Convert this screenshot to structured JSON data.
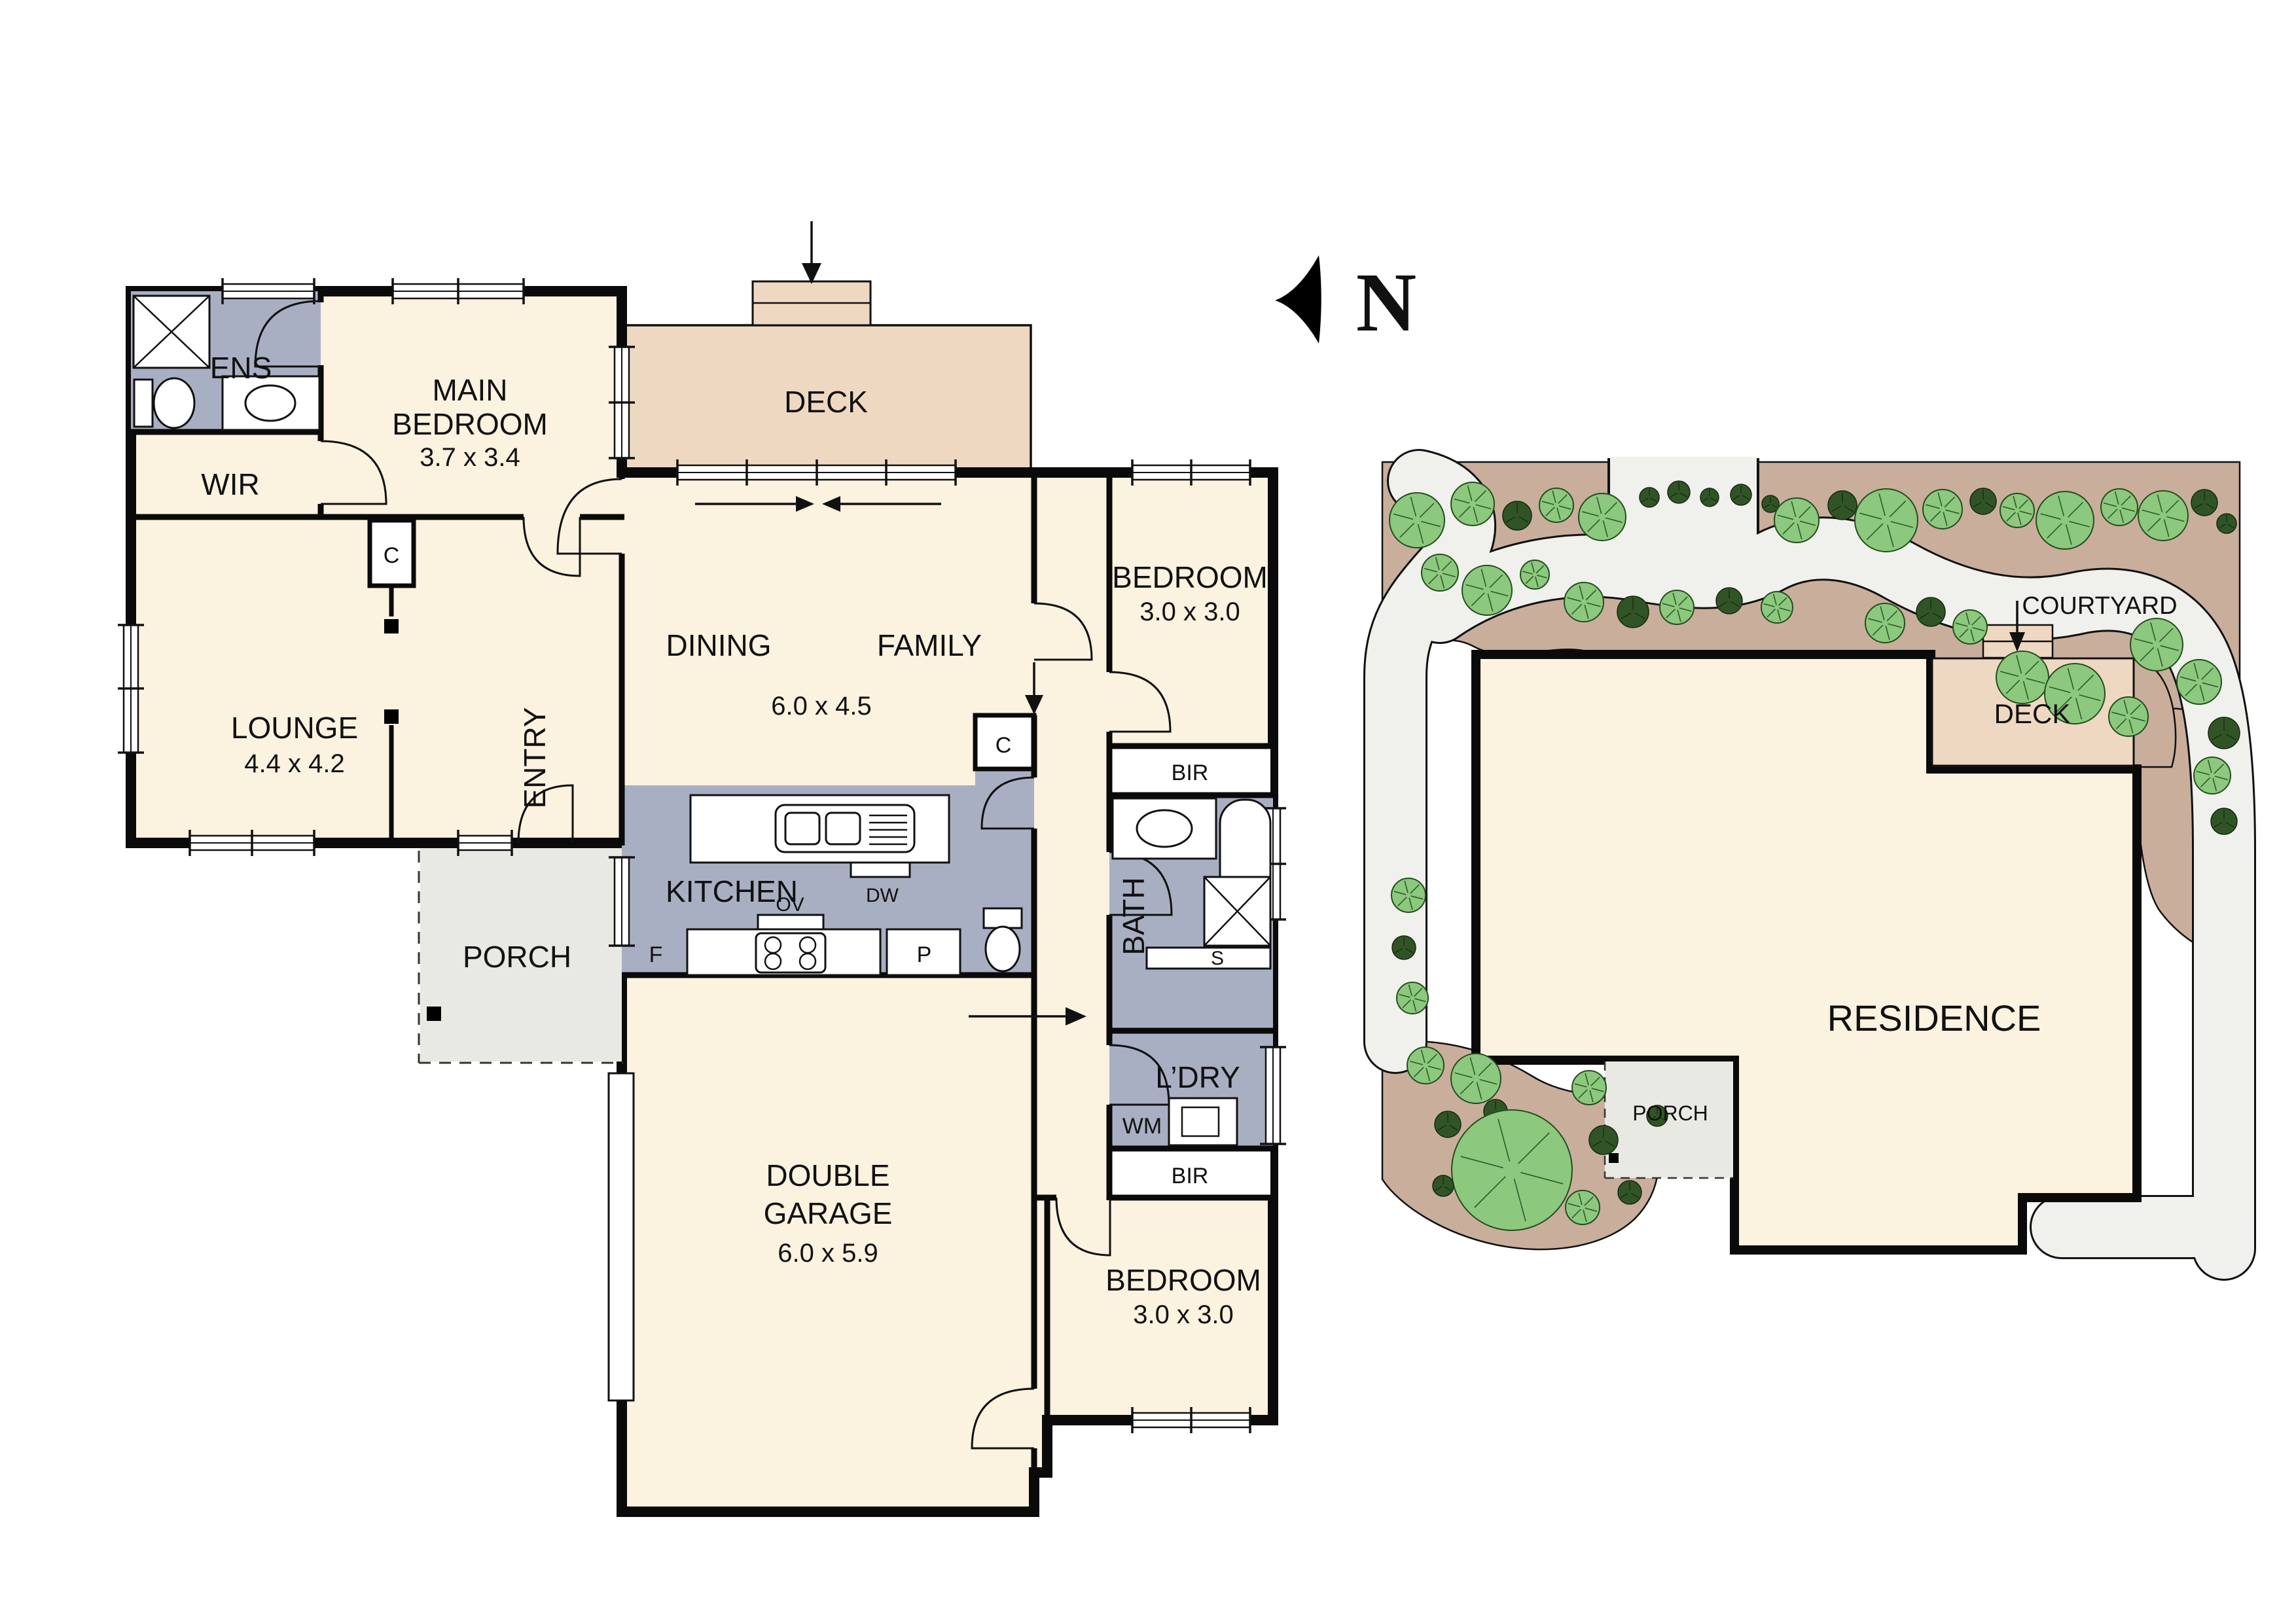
{
  "north": {
    "label": "N"
  },
  "floor_plan": {
    "ens": "ENS",
    "wir": "WIR",
    "main_bedroom": {
      "l1": "MAIN",
      "l2": "BEDROOM",
      "dim": "3.7 x 3.4"
    },
    "deck": "DECK",
    "lounge": {
      "l1": "LOUNGE",
      "dim": "4.4 x 4.2"
    },
    "entry": "ENTRY",
    "cupboard_entry": "C",
    "dining": "DINING",
    "family": "FAMILY",
    "living_dim": "6.0 x 4.5",
    "bedroom1": {
      "l1": "BEDROOM",
      "dim": "3.0 x 3.0"
    },
    "bir_top": "BIR",
    "bath": "BATH",
    "shelf": "S",
    "kitchen": "KITCHEN",
    "dw": "DW",
    "ov": "OV",
    "fridge": "F",
    "pantry": "P",
    "cupboard_hall": "C",
    "porch": "PORCH",
    "laundry": "L’DRY",
    "wm": "WM",
    "bir_bottom": "BIR",
    "bedroom2": {
      "l1": "BEDROOM",
      "dim": "3.0 x 3.0"
    },
    "garage": {
      "l1": "DOUBLE",
      "l2": "GARAGE",
      "dim": "6.0 x 5.9"
    }
  },
  "site_plan": {
    "courtyard": "COURTYARD",
    "deck": "DECK",
    "porch": "PORCH",
    "residence": "RESIDENCE"
  },
  "colors": {
    "room_fill": "#FBF2DF",
    "wet_fill": "#A9AFC3",
    "deck_fill": "#EFD8C2",
    "porch_fill": "#E9E9E4",
    "path_fill": "#F0F0EC",
    "garden_fill": "#C9AE9C",
    "tree_fill": "#8CC87D",
    "bush_fill": "#315426",
    "wall": "#0A0A0A"
  }
}
